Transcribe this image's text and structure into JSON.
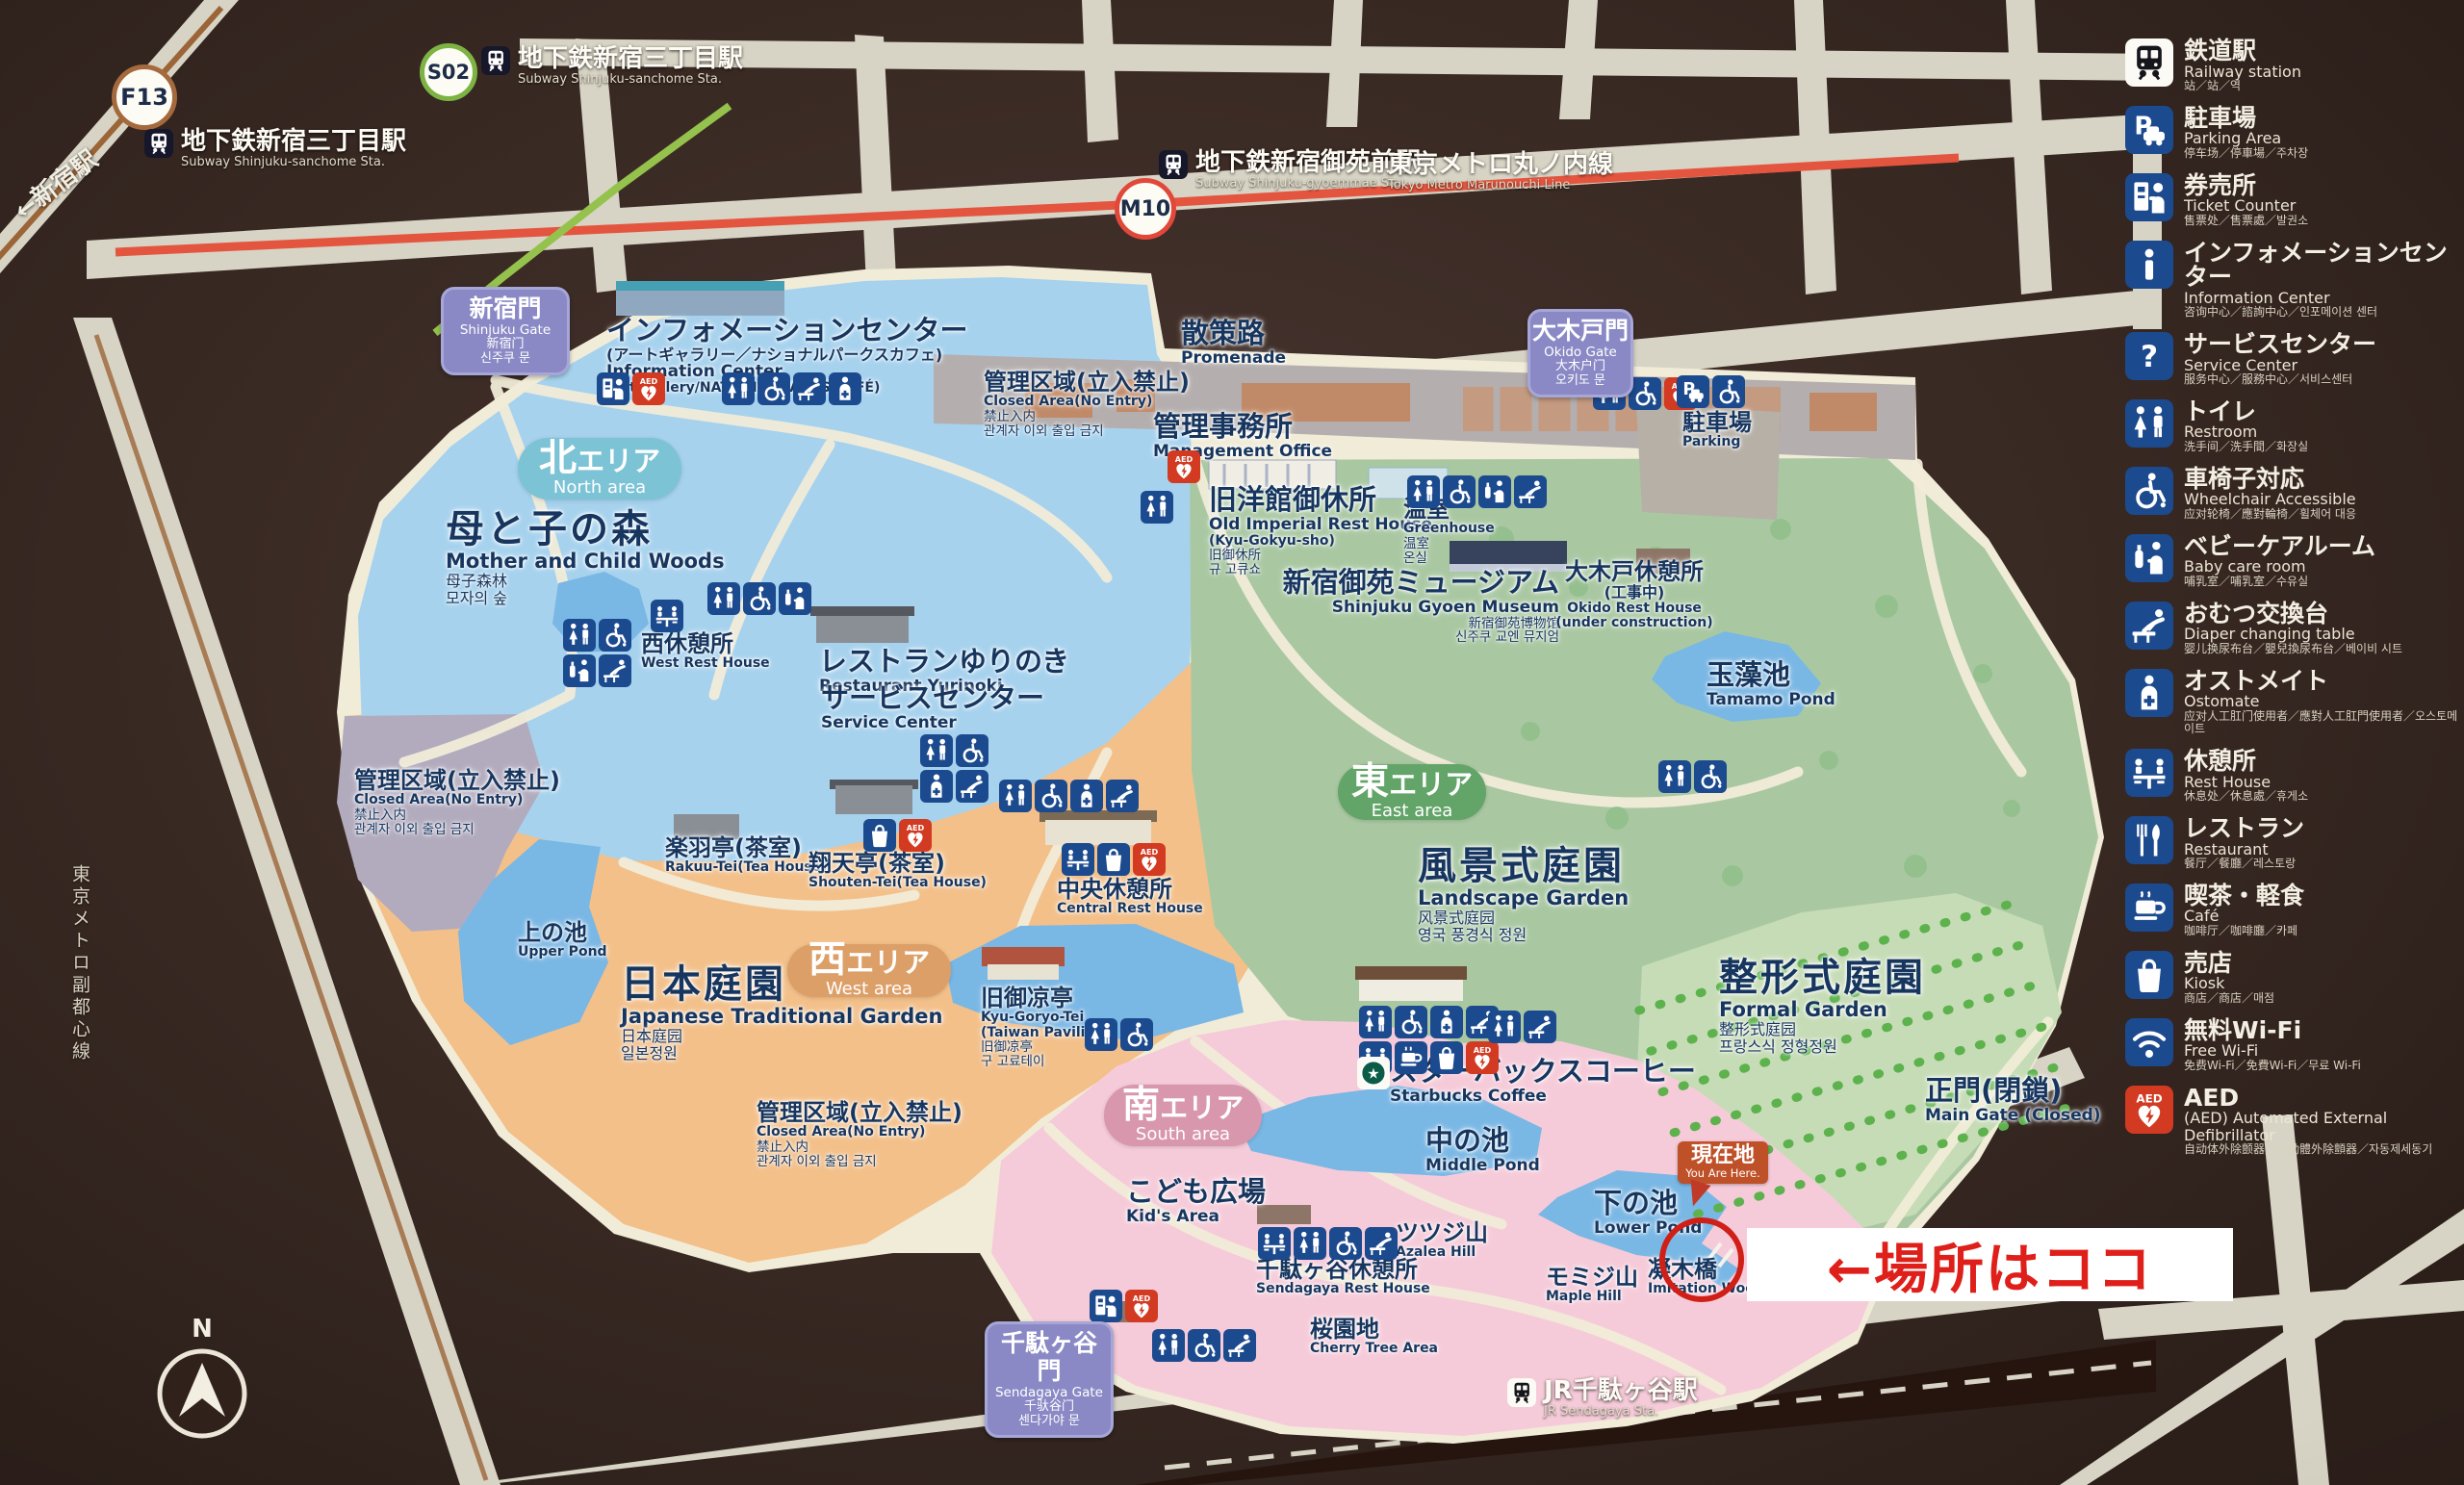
{
  "legend": {
    "items": [
      {
        "id": "railway-station",
        "icon": "train",
        "jp": "鉄道駅",
        "en": "Railway station",
        "sub": "站／站／역"
      },
      {
        "id": "parking-area",
        "icon": "parking",
        "jp": "駐車場",
        "en": "Parking Area",
        "sub": "停车场／停車場／주차장"
      },
      {
        "id": "ticket-counter",
        "icon": "ticket",
        "jp": "券売所",
        "en": "Ticket Counter",
        "sub": "售票处／售票處／발권소"
      },
      {
        "id": "information-center",
        "icon": "info",
        "jp": "インフォメーションセンター",
        "en": "Information Center",
        "sub": "咨询中心／諮詢中心／인포메이션 센터"
      },
      {
        "id": "service-center",
        "icon": "question",
        "jp": "サービスセンター",
        "en": "Service Center",
        "sub": "服务中心／服務中心／서비스센터"
      },
      {
        "id": "restroom",
        "icon": "restroom",
        "jp": "トイレ",
        "en": "Restroom",
        "sub": "洗手间／洗手間／화장실"
      },
      {
        "id": "wheelchair-accessible",
        "icon": "wheelchair",
        "jp": "車椅子対応",
        "en": "Wheelchair Accessible",
        "sub": "应对轮椅／應對輪椅／휠체어 대응"
      },
      {
        "id": "baby-care-room",
        "icon": "baby",
        "jp": "ベビーケアルーム",
        "en": "Baby care room",
        "sub": "哺乳室／哺乳室／수유실"
      },
      {
        "id": "diaper-changing-table",
        "icon": "diaper",
        "jp": "おむつ交換台",
        "en": "Diaper changing table",
        "sub": "婴儿换尿布台／嬰兒換尿布台／베이비 시트"
      },
      {
        "id": "ostomate",
        "icon": "ostomate",
        "jp": "オストメイト",
        "en": "Ostomate",
        "sub": "应对人工肛门使用者／應對人工肛門使用者／오스토메이트"
      },
      {
        "id": "rest-house",
        "icon": "resthouse",
        "jp": "休憩所",
        "en": "Rest House",
        "sub": "休息处／休息處／휴게소"
      },
      {
        "id": "restaurant",
        "icon": "restaurant",
        "jp": "レストラン",
        "en": "Restaurant",
        "sub": "餐厅／餐廳／레스토랑"
      },
      {
        "id": "cafe",
        "icon": "cafe",
        "jp": "喫茶・軽食",
        "en": "Café",
        "sub": "咖啡厅／咖啡廳／카페"
      },
      {
        "id": "kiosk",
        "icon": "kiosk",
        "jp": "売店",
        "en": "Kiosk",
        "sub": "商店／商店／매점"
      },
      {
        "id": "free-wifi",
        "icon": "wifi",
        "jp": "無料Wi-Fi",
        "en": "Free Wi-Fi",
        "sub": "免费Wi-Fi／免費Wi-Fi／무료 Wi-Fi"
      },
      {
        "id": "aed",
        "icon": "aed",
        "jp": "AED",
        "en": "(AED) Automated External Defibrillator",
        "sub": "自动体外除颤器／自動體外除顫器／자동제세동기"
      }
    ]
  },
  "stations": {
    "f13": {
      "badge": "F13",
      "jp": "地下鉄新宿三丁目駅",
      "en": "Subway Shinjuku-sanchome Sta."
    },
    "s02": {
      "badge": "S02",
      "jp": "地下鉄新宿三丁目駅",
      "en": "Subway Shinjuku-sanchome Sta."
    },
    "m10": {
      "badge": "M10",
      "jp": "地下鉄新宿御苑前駅",
      "en": "Subway Shinjuku-gyoemmae Sta."
    },
    "jr": {
      "jp": "JR千駄ヶ谷駅",
      "en": "JR Sendagaya Sta."
    }
  },
  "lines_labels": {
    "marunouchi": {
      "jp": "東京メトロ丸ノ内線",
      "en": "Tokyo Metro Marunouchi Line"
    },
    "fukutoshin": "東京メトロ副都心線",
    "to_shinjuku": "←新宿駅"
  },
  "areas": {
    "north": {
      "jp": "北エリア",
      "en": "North area"
    },
    "west": {
      "jp": "西エリア",
      "en": "West area"
    },
    "east": {
      "jp": "東エリア",
      "en": "East area"
    },
    "south": {
      "jp": "南エリア",
      "en": "South area"
    }
  },
  "gates": {
    "shinjuku": {
      "jp": "新宿門",
      "en": "Shinjuku Gate",
      "cn": "新宿门",
      "kr": "신주쿠 문"
    },
    "okido": {
      "jp": "大木戸門",
      "en": "Okido Gate",
      "cn": "大木户门",
      "kr": "오키도 문"
    },
    "sendagaya": {
      "jp": "千駄ヶ谷門",
      "en": "Sendagaya Gate",
      "cn": "千驮谷门",
      "kr": "센다가야 문"
    }
  },
  "pois": {
    "info_center": {
      "jp": "インフォメーションセンター",
      "jp2": "(アートギャラリー／ナショナルパークスカフェ)",
      "en": "Information Center",
      "en2": "(Art Gallery/NATIONAL PARKS CAFÉ)"
    },
    "promenade": {
      "jp": "散策路",
      "en": "Promenade"
    },
    "closed_north": {
      "jp": "管理区域(立入禁止)",
      "en": "Closed Area(No Entry)",
      "cn": "禁止入内",
      "kr": "관계자 이외 출입 금지"
    },
    "closed_west": {
      "jp": "管理区域(立入禁止)",
      "en": "Closed Area(No Entry)",
      "cn": "禁止入内",
      "kr": "관계자 이외 출입 금지"
    },
    "closed_south": {
      "jp": "管理区域(立入禁止)",
      "en": "Closed Area(No Entry)",
      "cn": "禁止入内",
      "kr": "관계자 이외 출입 금지"
    },
    "mgmt_office": {
      "jp": "管理事務所",
      "en": "Management Office"
    },
    "old_imperial": {
      "jp": "旧洋館御休所",
      "en": "Old Imperial Rest House",
      "en2": "(Kyu-Gokyu-sho)",
      "cn": "旧御休所",
      "kr": "규 고큐쇼"
    },
    "greenhouse": {
      "jp": "温室",
      "en": "Greenhouse",
      "cn": "温室",
      "kr": "온실"
    },
    "museum": {
      "jp": "新宿御苑ミュージアム",
      "en": "Shinjuku Gyoen Museum",
      "cn": "新宿御苑博物馆",
      "kr": "신주쿠 교엔 뮤지엄"
    },
    "okido_rest": {
      "jp": "大木戸休憩所",
      "jp2": "(工事中)",
      "en": "Okido Rest House",
      "en2": "(under construction)"
    },
    "parking_lot": {
      "jp": "駐車場",
      "en": "Parking"
    },
    "tamamo": {
      "jp": "玉藻池",
      "en": "Tamamo Pond"
    },
    "north_woods": {
      "jp": "母と子の森",
      "en": "Mother and Child Woods",
      "cn": "母子森林",
      "kr": "모자의 숲"
    },
    "west_rest": {
      "jp": "西休憩所",
      "en": "West Rest House"
    },
    "yurinoki": {
      "jp": "レストランゆりのき",
      "en": "Restaurant Yurinoki"
    },
    "service_center": {
      "jp": "サービスセンター",
      "en": "Service Center"
    },
    "rakuu": {
      "jp": "楽羽亭(茶室)",
      "en": "Rakuu-Tei(Tea House)"
    },
    "shouten": {
      "jp": "翔天亭(茶室)",
      "en": "Shouten-Tei(Tea House)"
    },
    "central_rest": {
      "jp": "中央休憩所",
      "en": "Central Rest House"
    },
    "upper_pond": {
      "jp": "上の池",
      "en": "Upper Pond"
    },
    "jp_garden": {
      "jp": "日本庭園",
      "en": "Japanese Traditional Garden",
      "cn": "日本庭园",
      "kr": "일본정원"
    },
    "goryotei": {
      "jp": "旧御凉亭",
      "en": "Kyu-Goryo-Tei",
      "en2": "(Taiwan Pavilion)",
      "cn": "旧御凉亭",
      "kr": "구 고료테이"
    },
    "landscape": {
      "jp": "風景式庭園",
      "en": "Landscape Garden",
      "cn": "风景式庭园",
      "kr": "영국 풍경식 정원"
    },
    "formal": {
      "jp": "整形式庭園",
      "en": "Formal Garden",
      "cn": "整形式庭园",
      "kr": "프랑스식 정형정원"
    },
    "main_gate": {
      "jp": "正門(閉鎖)",
      "en": "Main Gate (Closed)"
    },
    "starbucks": {
      "jp": "スターバックスコーヒー",
      "en": "Starbucks Coffee"
    },
    "middle_pond": {
      "jp": "中の池",
      "en": "Middle Pond"
    },
    "lower_pond": {
      "jp": "下の池",
      "en": "Lower Pond"
    },
    "kids": {
      "jp": "こども広場",
      "en": "Kid's Area"
    },
    "azalea": {
      "jp": "ツツジ山",
      "en": "Azalea Hill"
    },
    "maple": {
      "jp": "モミジ山",
      "en": "Maple Hill"
    },
    "bridge": {
      "jp": "凝木橋",
      "en": "Imitation Wooden Bridge"
    },
    "sendagaya_rest": {
      "jp": "千駄ヶ谷休憩所",
      "en": "Sendagaya Rest House"
    },
    "cherry": {
      "jp": "桜園地",
      "en": "Cherry Tree Area"
    },
    "you_are_here": {
      "jp": "現在地",
      "en": "You Are Here."
    }
  },
  "annotation": {
    "text": "←場所はココ"
  },
  "compass": {
    "label": "N"
  },
  "colors": {
    "accent_red": "#d6251f",
    "icon_blue": "#1c4a8e",
    "aed_red": "#d23a22",
    "area_north": "#7cc3d6",
    "area_west": "#dd9f68",
    "area_east": "#63a468",
    "area_south": "#d897ad",
    "gate_purple": "#8a89c5",
    "you_are_here_bg": "#bf5129",
    "line_marunouchi": "#e4553f",
    "line_green": "#94c24c"
  }
}
